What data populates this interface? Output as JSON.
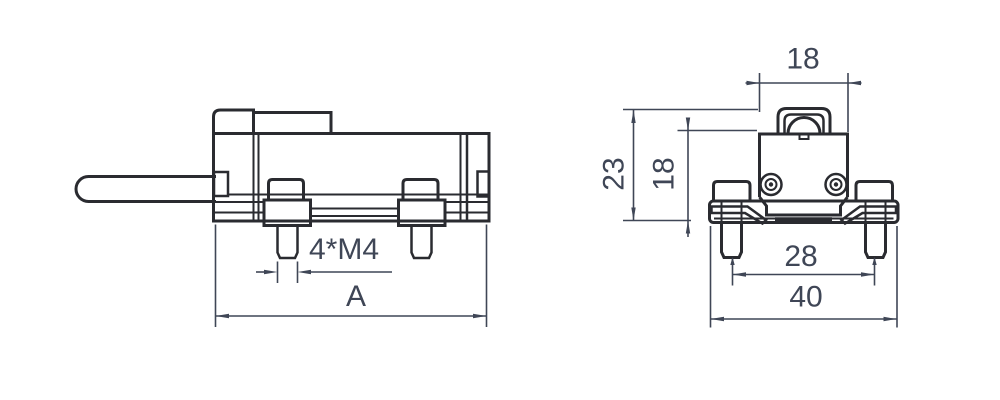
{
  "drawing": {
    "kind": "technical-drawing",
    "colors": {
      "background": "#ffffff",
      "outline": "#2a2b30",
      "dimension": "#3f4656"
    },
    "views": {
      "side": {
        "label": "side-view",
        "dims": {
          "thread_spec": "4*M4",
          "overall_length": "A"
        }
      },
      "front": {
        "label": "front-view",
        "dims": {
          "head_width": "18",
          "total_height": "23",
          "body_height": "18",
          "stud_spacing": "28",
          "base_width": "40"
        }
      }
    }
  }
}
